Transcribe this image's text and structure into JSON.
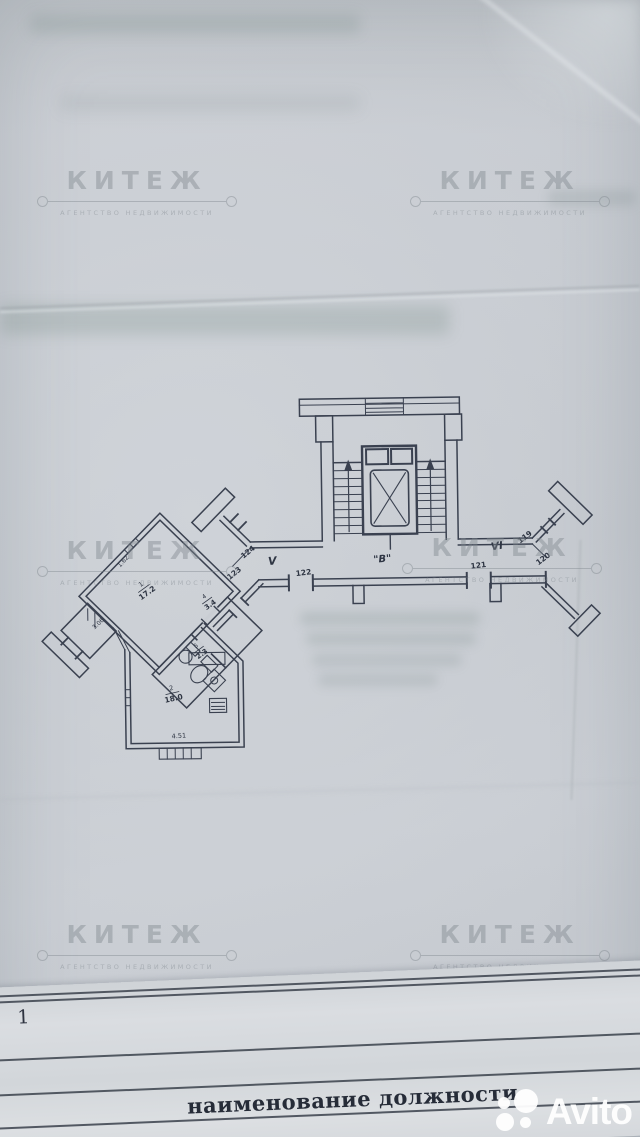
{
  "photo": {
    "watermark": {
      "title": "КИТЕЖ",
      "subtitle": "АГЕНТСТВО НЕДВИЖИМОСТИ"
    },
    "plan": {
      "stair_label": "\"В\"",
      "corridors": {
        "left": "V",
        "right": "VI"
      },
      "doors": {
        "n119": "119",
        "n120": "120",
        "n121": "121",
        "n122": "122",
        "n123": "123",
        "n124": "124"
      },
      "rooms": {
        "living": {
          "num": "1",
          "area": "17.2"
        },
        "hall": {
          "num": "4",
          "area": "3.4"
        },
        "wc": {
          "num": "5",
          "area": "2.3"
        },
        "kitchen": {
          "num": "2",
          "area": "18.0"
        }
      },
      "dimensions": {
        "bottom": "4.51",
        "left": "3.06",
        "top_left": "1.62"
      }
    },
    "bottom_sheet": {
      "page_marker": "5 1",
      "caption": "наименование должности"
    },
    "brand": {
      "name": "Avito"
    }
  }
}
